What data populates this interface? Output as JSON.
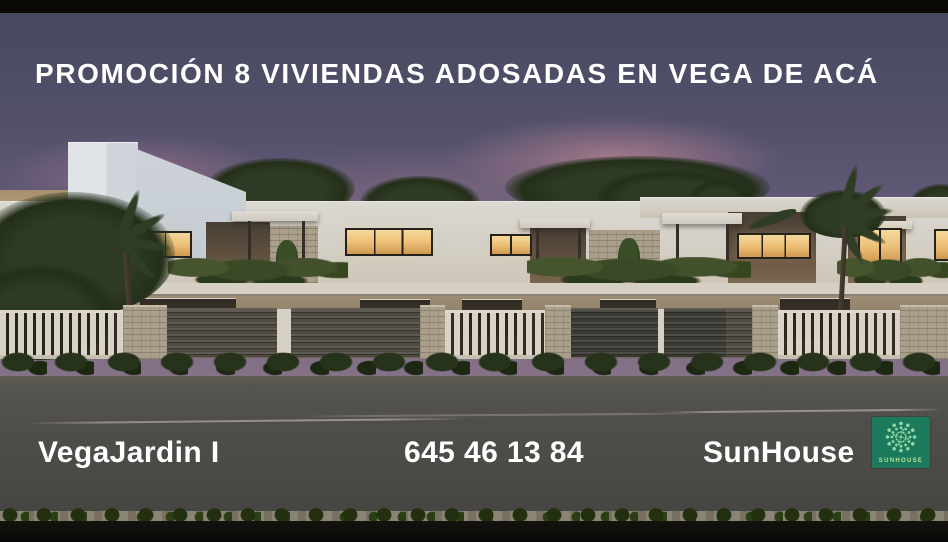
{
  "header": {
    "title": "PROMOCIÓN 8 VIVIENDAS ADOSADAS EN VEGA DE ACÁ"
  },
  "footer": {
    "project_name": "VegaJardin I",
    "phone": "645 46 13 84",
    "brand_name": "SunHouse"
  },
  "logo": {
    "wordmark": "SUNHOUSE",
    "icon": "sunburst-dots-icon"
  },
  "colors": {
    "brand_green": "#1a7a5b",
    "logo_dots": "#93d4a5",
    "logo_wordmark": "#b9e096",
    "overlay_text": "#ffffff"
  }
}
